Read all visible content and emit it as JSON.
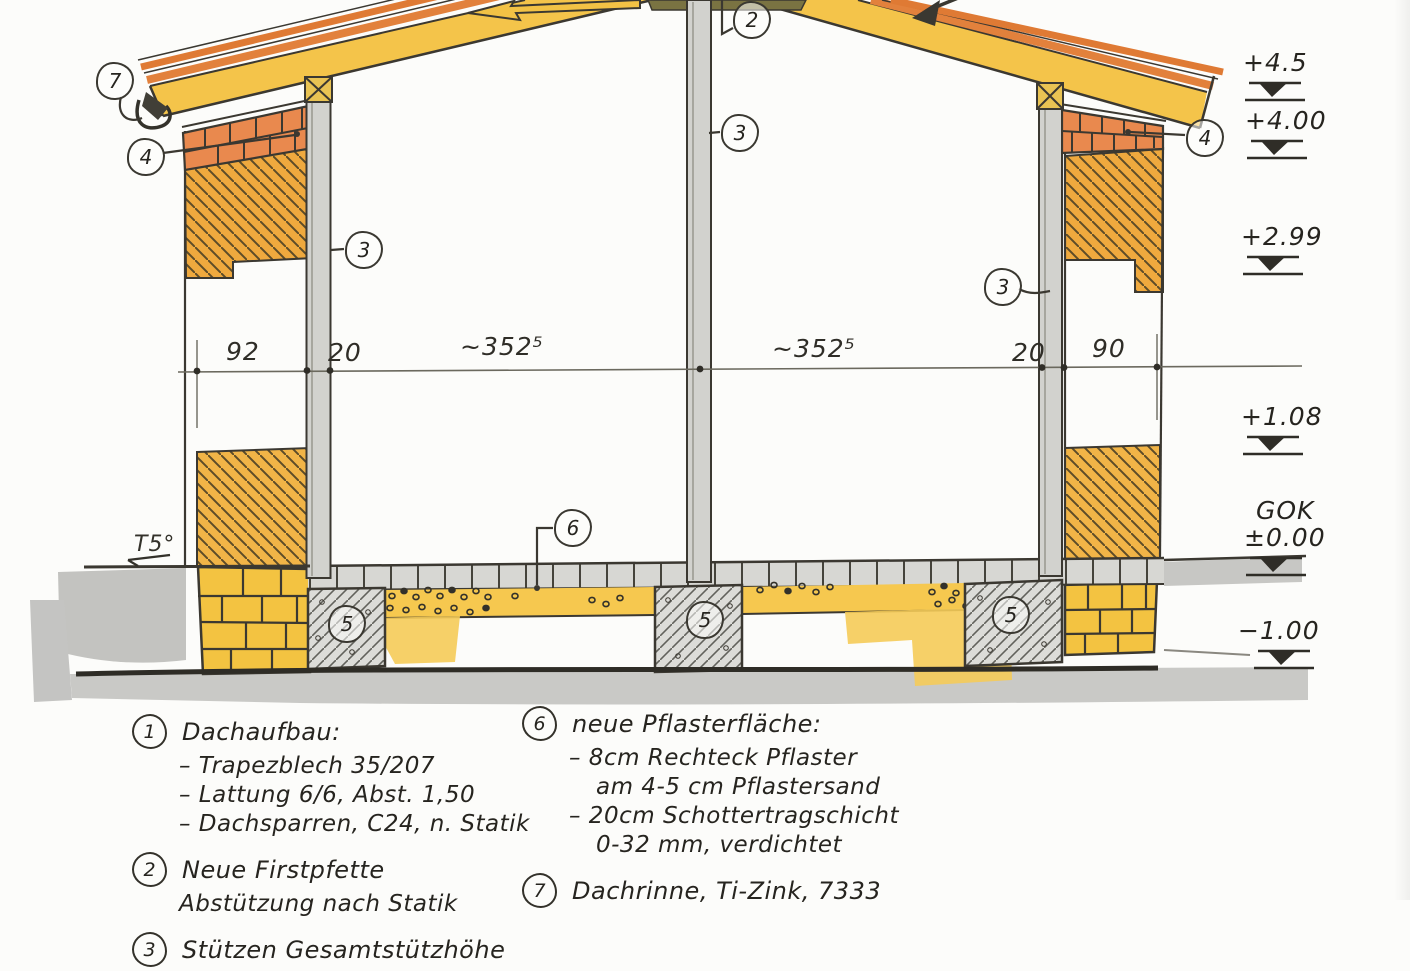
{
  "meta": {
    "description": "Hand-drawn building cross-section sketch with German renovation notes"
  },
  "drawing": {
    "callouts": {
      "c2": "2",
      "c3": "3",
      "c4": "4",
      "c5": "5",
      "c6": "6",
      "c7": "7"
    },
    "dimension_labels": {
      "left_wall": "92",
      "left_post": "20",
      "left_span": "~352⁵",
      "right_span": "~352⁵",
      "right_post": "20",
      "right_wall": "90"
    },
    "terrain_label": "T5°",
    "elevations": [
      {
        "label": "+4.5"
      },
      {
        "label": "+4.00"
      },
      {
        "label": "+2.99"
      },
      {
        "label": "+1.08"
      },
      {
        "label": "GOK",
        "sub": "±0.00"
      },
      {
        "label": "−1.00"
      }
    ]
  },
  "notes_left": {
    "item1": {
      "num": "1",
      "title": "Dachaufbau:",
      "lines": [
        "– Trapezblech 35/207",
        "– Lattung 6/6, Abst. 1,50",
        "– Dachsparren, C24, n. Statik"
      ]
    },
    "item2": {
      "num": "2",
      "lines": [
        "Neue Firstpfette",
        "Abstützung nach Statik"
      ]
    },
    "item3": {
      "num": "3",
      "lines": [
        "Stützen Gesamtstützhöhe"
      ]
    }
  },
  "notes_right": {
    "item6": {
      "num": "6",
      "title": "neue Pflasterfläche:",
      "lines": [
        "– 8cm Rechteck Pflaster",
        "am 4-5 cm Pflastersand",
        "– 20cm Schottertragschicht",
        "0-32 mm, verdichtet"
      ]
    },
    "item7": {
      "num": "7",
      "lines": [
        "Dachrinne, Ti-Zink, 7333"
      ]
    }
  },
  "colors": {
    "ink": "#3b3831",
    "roof_yellow": "#f4c44a",
    "sheet_orange": "#e2813c",
    "brick_orange": "#e9894e",
    "wall_hatch_orange": "#efa93e",
    "post_gray": "#d2d2ce",
    "concrete_gray": "#dcdcd8",
    "stone_yellow": "#f3c341",
    "terrain_gray": "#c3c3c0"
  }
}
